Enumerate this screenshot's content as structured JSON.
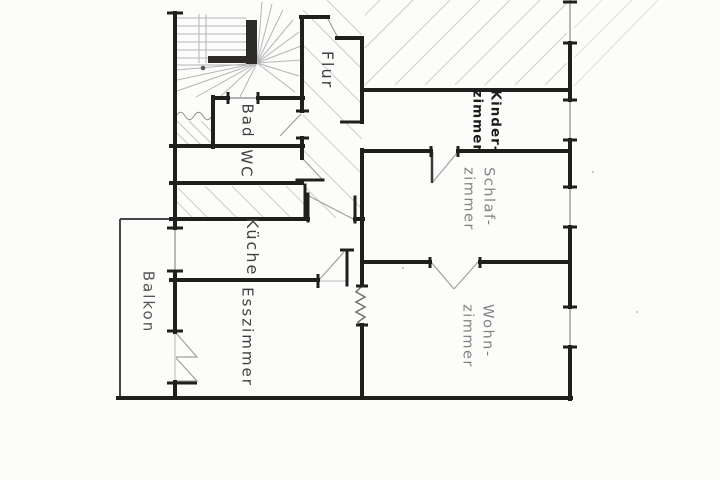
{
  "drawing": {
    "kind": "apartment floor plan (hand-drawn)",
    "colors": {
      "paper": "#fcfcfa",
      "wall_ink": "#211f1d",
      "pencil_hatch": "#cdcdcd",
      "stair_pencil": "#b5b5b5",
      "label_ink": "#3f3f3f",
      "label_pencil": "#828282",
      "label_bold_ink": "#1c1c1c"
    }
  },
  "rooms": {
    "flur": {
      "label": "Flur"
    },
    "bad": {
      "label": "Bad"
    },
    "wc": {
      "label": "WC"
    },
    "kueche": {
      "label": "Küche"
    },
    "esszimmer": {
      "label": "Esszimmer"
    },
    "balkon": {
      "label": "Balkon"
    },
    "kinderzimmer": {
      "label": "Kinder-\nzimmer"
    },
    "schlafzimmer": {
      "label": "Schlaf-\nzimmer"
    },
    "wohnzimmer": {
      "label": "Wohn-\nzimmer"
    }
  }
}
